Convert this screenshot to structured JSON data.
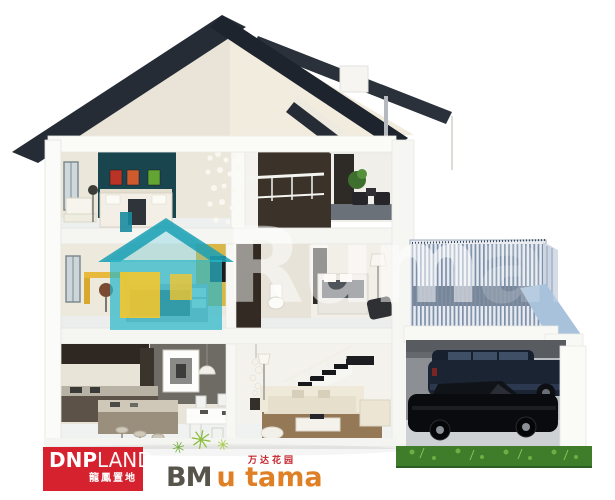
{
  "watermark": {
    "text_main": "Rum",
    "text_faded": "ah",
    "house_icon_color": "#2ab4c6",
    "house_icon_window_color": "#f6c52e"
  },
  "logos": {
    "dnp_land": {
      "name_bold": "DNP",
      "name_light": "LAND",
      "chinese": "龍鳳置地",
      "background_color": "#d5222e",
      "text_color": "#ffffff"
    },
    "bm_utama": {
      "prefix": "BM",
      "suffix": "u tama",
      "chinese": "万达花园",
      "prefix_color": "#57544b",
      "suffix_color": "#e08026",
      "chinese_color": "#c4232b",
      "star_glyph": "✳",
      "star_color": "#7fb43c"
    }
  },
  "scene": {
    "colors": {
      "roof_dark": "#232a33",
      "gable_cream": "#f2ecdf",
      "teal_accent_wall": "#1a4650",
      "brown_accent_wall": "#3b332a",
      "desk_yellow": "#d9b648",
      "railing_blue_gray": "#7c90a9",
      "terrace_slope_blue": "#a9c2dc",
      "grass_green": "#3f7d2a",
      "suv_navy": "#1b2433",
      "sedan_black": "#0a0b0f",
      "sofa_cream": "#e6dfcc",
      "rug_brown": "#8d6f4a"
    }
  }
}
